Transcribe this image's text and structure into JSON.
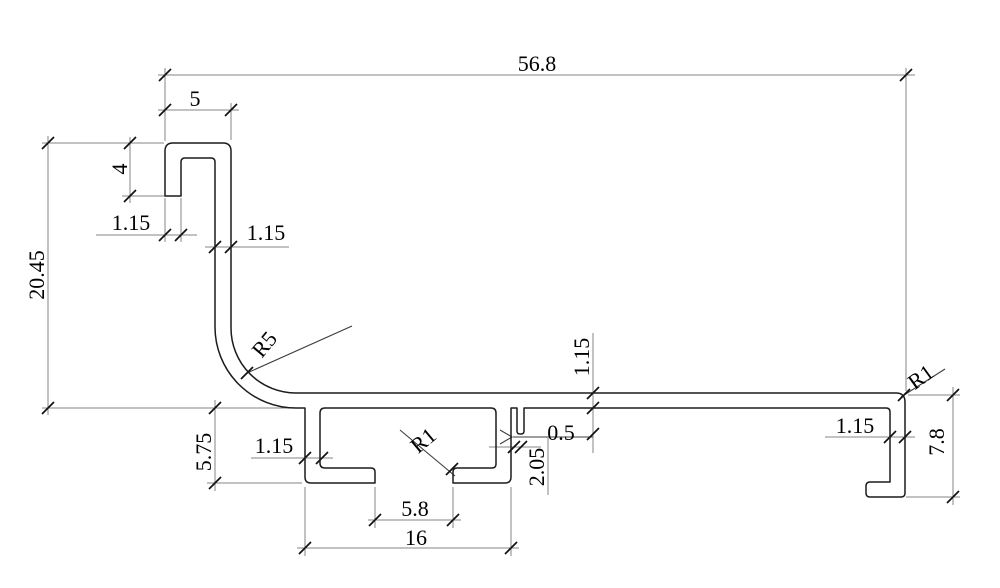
{
  "drawing": {
    "type": "profile-cross-section",
    "units": "mm",
    "background_color": "#ffffff",
    "profile_line_color": "#1c1c1c",
    "dimension_line_color": "#858585",
    "leader_line_color": "#3c3c3c",
    "tick_color": "#111111",
    "text_color": "#000000",
    "dims": {
      "overall_width": "56.8",
      "hook_outer_width": "5",
      "hook_leg_length": "4",
      "hook_leg_thickness": "1.15",
      "left_wall_thickness": "1.15",
      "overall_height_left": "20.45",
      "bend_radius": "R5",
      "channel_depth": "5.75",
      "channel_wall_thickness": "1.15",
      "channel_fillet_radius": "R1",
      "slot_width": "5.8",
      "channel_outer_width": "16",
      "lip_thickness": "0.5",
      "lip_depth": "2.05",
      "web_thickness": "1.15",
      "top_right_corner_radius": "R1",
      "right_wall_thickness": "1.15",
      "right_end_height": "7.8"
    }
  }
}
